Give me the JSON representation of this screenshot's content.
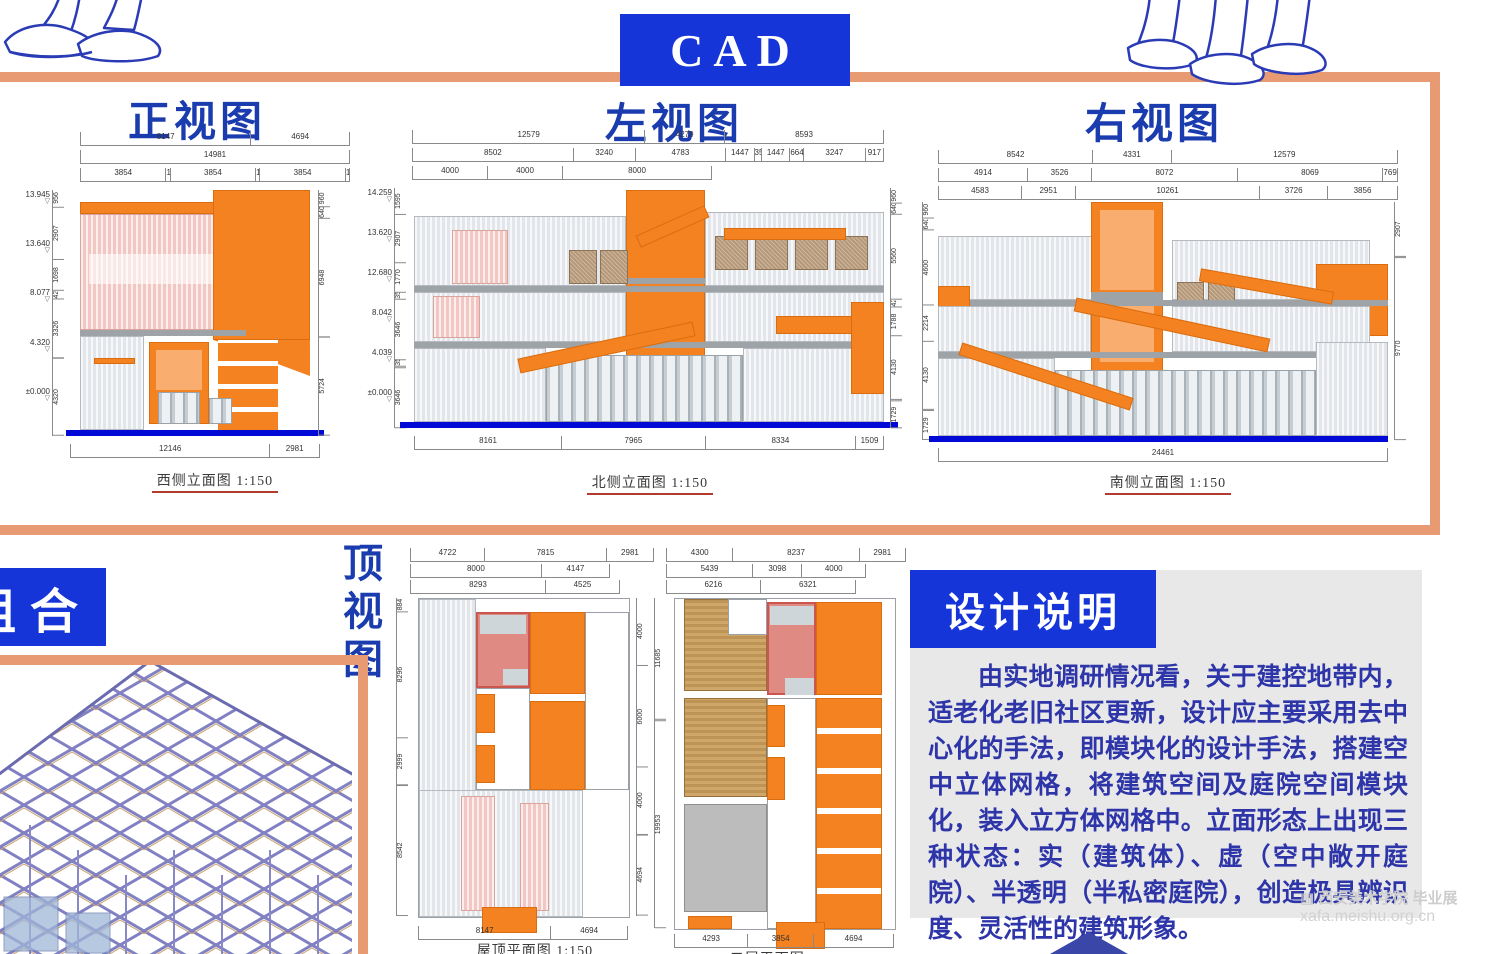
{
  "colors": {
    "orange": "#F58220",
    "orangelight": "#F9AD6E",
    "salmon": "#E89B72",
    "bluebox": "#1535D8",
    "bluetitle": "#1B3CAE",
    "bluetext": "#2D35A8",
    "groundblue": "#0009D6",
    "pink": "#E08A84",
    "mesh": "#B59877"
  },
  "header": {
    "cad_label": "CAD"
  },
  "figures": {
    "front": {
      "title": "正视图",
      "caption": "西侧立面图 1:150",
      "dims_top": [
        [
          "8147",
          "4694"
        ],
        [
          "14981"
        ],
        [
          "3854",
          "146",
          "3854",
          "146",
          "3854",
          "146"
        ]
      ],
      "levels_left": [
        "13.945",
        "13.640",
        "8.077",
        "4.320",
        "±0.000"
      ],
      "dims_left": [
        "956",
        "2907",
        "1698",
        "426",
        "3326",
        "4320"
      ],
      "dims_right": [
        "960",
        "640",
        "6948",
        "5724"
      ],
      "dims_bottom": [
        "12146",
        "2981"
      ]
    },
    "left_view": {
      "title": "左视图",
      "caption": "北侧立面图 1:150",
      "dims_top": [
        [
          "12579",
          "4279",
          "8593"
        ],
        [
          "8502",
          "3240",
          "4783",
          "1447",
          "353",
          "1447",
          "664",
          "3247",
          "917"
        ],
        [
          "4000",
          "4000",
          "8000"
        ]
      ],
      "levels_left": [
        "14.259",
        "13.620",
        "12.680",
        "8.042",
        "4.039",
        "±0.000"
      ],
      "dims_left": [
        "1595",
        "2907",
        "1770",
        "354",
        "3646",
        "354",
        "3646"
      ],
      "dims_right": [
        "960",
        "640",
        "5560",
        "426",
        "1788",
        "4130",
        "1729"
      ],
      "dims_bottom": [
        "8161",
        "7965",
        "8334",
        "1509"
      ]
    },
    "right_view": {
      "title": "右视图",
      "caption": "南侧立面图 1:150",
      "dims_top": [
        [
          "8542",
          "4331",
          "12579"
        ],
        [
          "4914",
          "3526",
          "8072",
          "8069",
          "769"
        ],
        [
          "4583",
          "2951",
          "10261",
          "3726",
          "3856"
        ]
      ],
      "dims_left": [
        "960",
        "640",
        "4600",
        "2214",
        "4130",
        "1729"
      ],
      "dims_right": [
        "2907",
        "9770"
      ],
      "dims_bottom": [
        "24461"
      ]
    },
    "roof_plan": {
      "caption": "屋顶平面图 1:150",
      "dims_top": [
        [
          "4722",
          "7815",
          "2981"
        ],
        [
          "8000",
          "4147"
        ],
        [
          "8293",
          "4525"
        ]
      ],
      "dims_left": [
        "884",
        "8296",
        "2999",
        "8542"
      ],
      "dims_right": [
        "4000",
        "6000",
        "4000",
        "4694"
      ],
      "dims_bottom": [
        "8147",
        "4694"
      ]
    },
    "second_plan": {
      "caption": "二层平面图 1:150",
      "dims_top": [
        [
          "4300",
          "8237",
          "2981"
        ],
        [
          "5439",
          "3098",
          "4000"
        ],
        [
          "6216",
          "6321"
        ]
      ],
      "dims_left": [
        "11685",
        "19953"
      ],
      "dims_bottom": [
        "4293",
        "3854",
        "4694"
      ]
    },
    "top_view_label": "顶视图",
    "combo_label": "组合"
  },
  "design_notes": {
    "title": "设计说明",
    "body": "由实地调研情况看，关于建控地带内，适老化老旧社区更新，设计应主要采用去中心化的手法，即模块化的设计手法，搭建空中立体网格，将建筑空间及庭院空间模块化，装入立方体网格中。立面形态上出现三种状态：实（建筑体）、虚（空中敞开庭院）、半透明（半私密庭院），创造极具辨识度、灵活性的建筑形象。"
  },
  "watermark": {
    "line1": "西安美术学院 毕业展",
    "line2": "xafa.meishu.org.cn"
  }
}
